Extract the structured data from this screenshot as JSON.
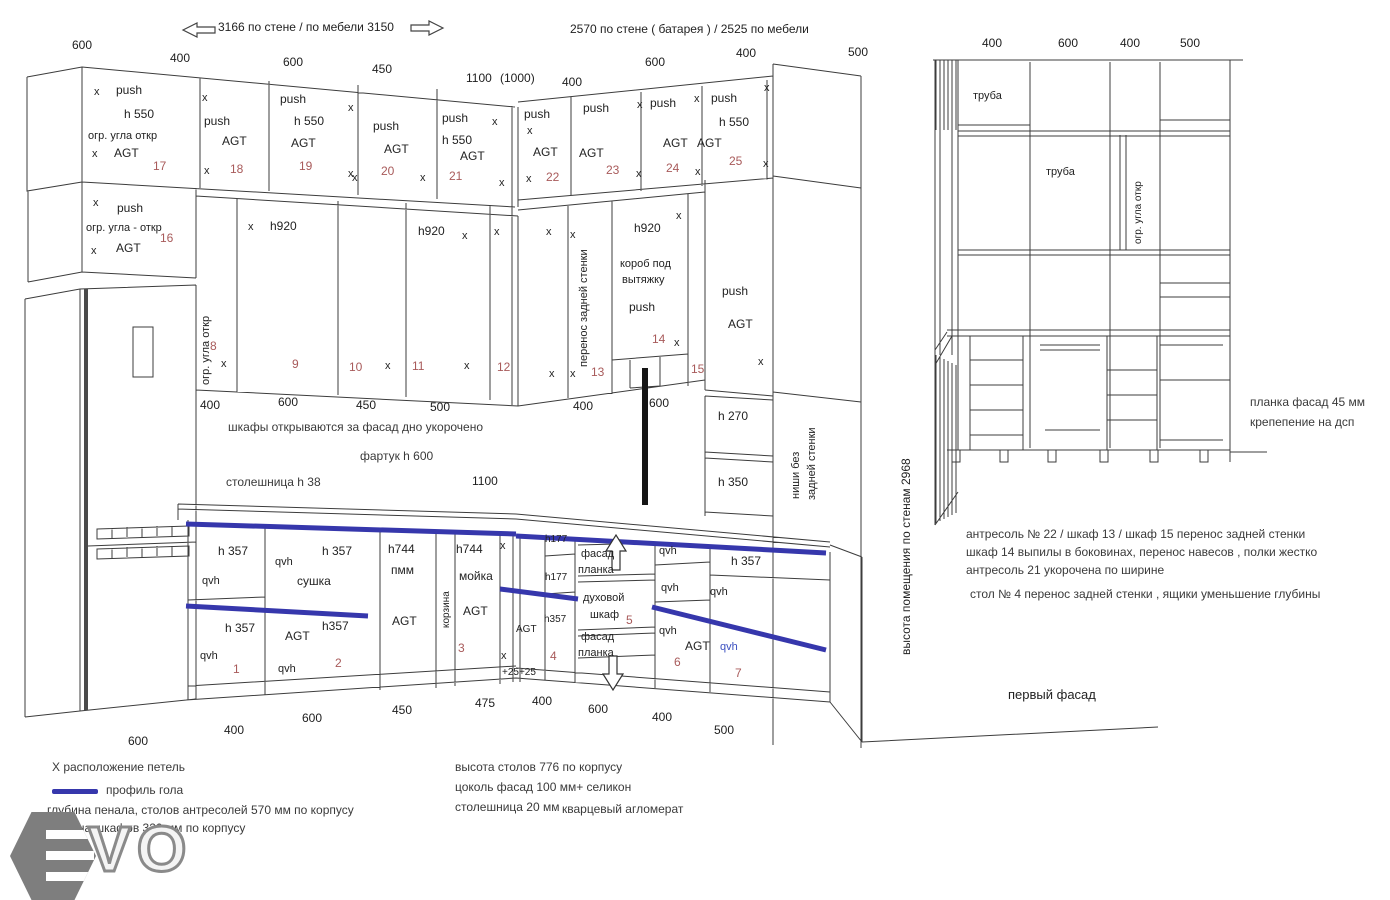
{
  "header": {
    "wall_left": "3166 по стене  / по мебели  3150",
    "wall_right": "2570 по стене  ( батарея )  /   2525   по мебели"
  },
  "tokens": {
    "x": "x",
    "push": "push",
    "agt": "AGT",
    "qvh": "qvh",
    "h550": "h  550",
    "h920": "h920",
    "h357": "h 357",
    "h357t": "h357",
    "h744": "h744",
    "h177": "h177",
    "pmm": "пмм",
    "ogr_ugla": "огр. угла откр",
    "ogr_ugla16": "огр. угла  -  откр",
    "plus25": "+25+25"
  },
  "nums": {
    "n1": "1",
    "n2": "2",
    "n3": "3",
    "n4": "4",
    "n5": "5",
    "n6": "6",
    "n7": "7",
    "n8": "8",
    "n9": "9",
    "n10": "10",
    "n11": "11",
    "n12": "12",
    "n13": "13",
    "n14": "14",
    "n15": "15",
    "n16": "16",
    "n17": "17",
    "n18": "18",
    "n19": "19",
    "n20": "20",
    "n21": "21",
    "n22": "22",
    "n23": "23",
    "n24": "24",
    "n25": "25"
  },
  "dims": {
    "top": [
      "600",
      "400",
      "600",
      "450",
      "1100",
      "(1000)",
      "400",
      "600",
      "400",
      "500"
    ],
    "mid": [
      "400",
      "600",
      "450",
      "500",
      "400",
      "600"
    ],
    "bottom": [
      "600",
      "400",
      "600",
      "450",
      "475",
      "400",
      "600",
      "400",
      "500"
    ],
    "facade_top": [
      "400",
      "600",
      "400",
      "500"
    ]
  },
  "labels": {
    "h270": "h 270",
    "h350": "h 350",
    "sushka": "сушка",
    "moyka": "мойка",
    "korzina": "корзина",
    "perenos": "перенос задней стенки",
    "korob1": "короб под",
    "korob2": "вытяжку",
    "nishi1": "ниши без",
    "nishi2": "задней стенки",
    "fasad": "фасад",
    "planka": "планка",
    "duhovoy": "духовой",
    "shkaf": "шкаф",
    "height_room": "высота  помещения по   стенам   2968",
    "truba": "труба",
    "cab_open": "шкафы открываются за фасад   дно укорочено",
    "fartuk": "фартук h  600",
    "stoleshnica38": "столешница h 38",
    "dim1100": "1100"
  },
  "notes_left": [
    "X расположение петель",
    "профиль гола",
    "глубина пенала, столов антресолей 570 мм по корпусу",
    "глубина шкафов 320 мм по корпусу"
  ],
  "notes_center": [
    "высота столов 776 по корпусу",
    "цоколь фасад 100 мм+ селикон",
    "столешница    20 мм",
    "кварцевый  агломерат"
  ],
  "facade": {
    "planka1": "планка фасад  45 мм",
    "planka2": "крепепение на дсп",
    "title": "первый фасад",
    "notes": [
      "антресоль № 22 / шкаф 13 / шкаф 15  перенос задней стенки",
      "шкаф 14 выпилы в боковинах, перенос навесов , полки жестко",
      "антресоль 21 укорочена по ширине",
      "стол  № 4 перенос задней стенки , ящики уменьшение глубины"
    ]
  },
  "watermark": "VO"
}
